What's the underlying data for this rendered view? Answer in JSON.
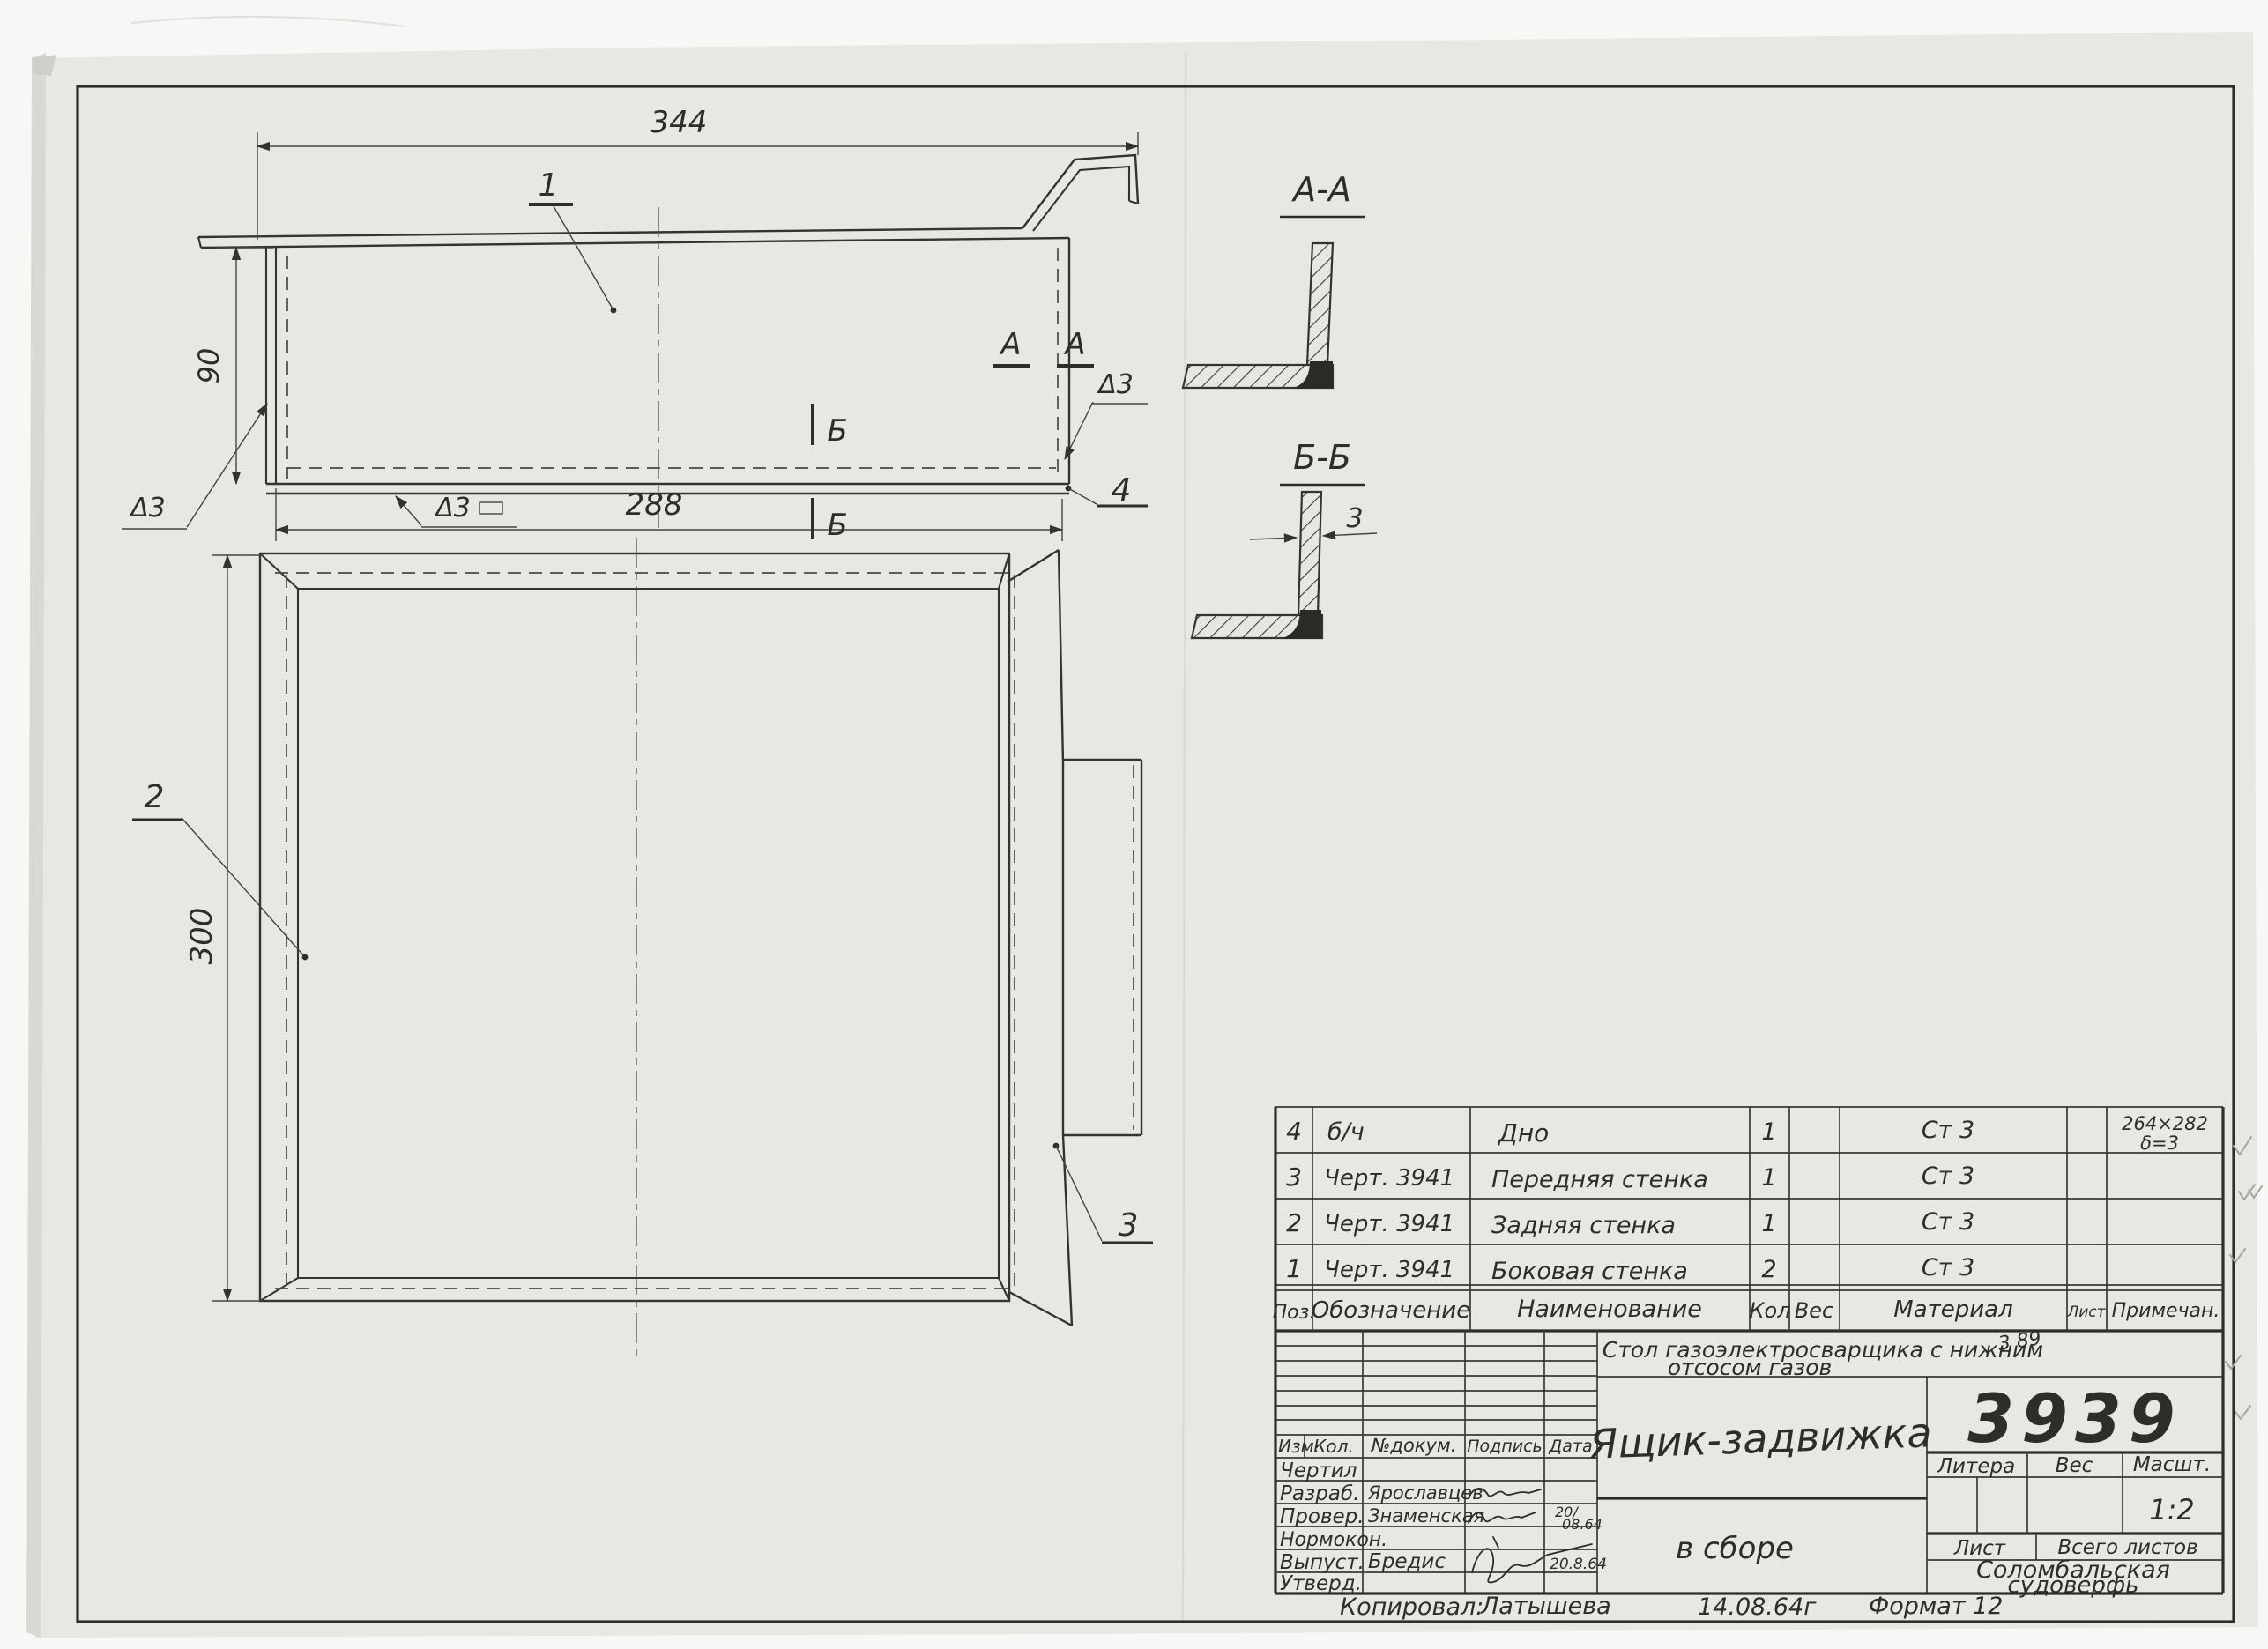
{
  "sheet": {
    "number": "3939",
    "title": "Ящик-задвижка",
    "project_line1": "Стол газоэлектросварщика с нижним",
    "project_line2": "отсосом газов",
    "assembly_note": "в сборе",
    "shipyard_line1": "Соломбальская",
    "shipyard_line2": "судоверфь",
    "scale_value": "1:2",
    "copied_label": "Копировал:",
    "copied_by": "Латышева",
    "copy_date": "14.08.64г",
    "format_note": "Формат 12",
    "pencil_note": "3 89"
  },
  "dims": {
    "overall_width": "344",
    "inner_width": "288",
    "depth": "90",
    "height": "300",
    "thickness": "3"
  },
  "sections": {
    "aa_title": "А-А",
    "bb_title": "Б-Б",
    "mark_a": "А",
    "mark_b": "Б"
  },
  "welds": {
    "left": "Δ3",
    "bottom": "Δ3",
    "right": "Δ3"
  },
  "callouts": {
    "c1": "1",
    "c2": "2",
    "c3": "3",
    "c4": "4"
  },
  "parts_table": {
    "headers": {
      "pos": "Поз.",
      "designation": "Обозначение",
      "name": "Наименование",
      "qty": "Кол",
      "weight": "Вес",
      "material": "Материал",
      "sheet": "Лист",
      "note": "Примечан."
    },
    "rows": [
      {
        "pos": "4",
        "designation": "б/ч",
        "name": "Дно",
        "qty": "1",
        "material": "Ст 3",
        "note1": "264×282",
        "note2": "δ=3"
      },
      {
        "pos": "3",
        "designation": "Черт. 3941",
        "name": "Передняя стенка",
        "qty": "1",
        "material": "Ст 3"
      },
      {
        "pos": "2",
        "designation": "Черт. 3941",
        "name": "Задняя стенка",
        "qty": "1",
        "material": "Ст 3"
      },
      {
        "pos": "1",
        "designation": "Черт. 3941",
        "name": "Боковая стенка",
        "qty": "2",
        "material": "Ст 3"
      }
    ]
  },
  "title_block": {
    "rev_headers": {
      "izm": "Изм.",
      "kol": "Кол.",
      "doc": "№докум.",
      "sign": "Подпись",
      "date": "Дата"
    },
    "roles": {
      "drew": "Чертил",
      "developed": "Разраб.",
      "checked": "Провер.",
      "norm": "Нормокон.",
      "released": "Выпуст.",
      "approved": "Утверд."
    },
    "people": {
      "developed": "Ярославцев",
      "checked": "Знаменская",
      "released": "Бредис"
    },
    "dates": {
      "checked_top": "20/",
      "checked_bottom": "08.64",
      "released": "20.8.64"
    },
    "litera_label": "Литера",
    "weight_label": "Вес",
    "scale_label": "Масшт.",
    "sheet_label": "Лист",
    "total_sheets_label": "Всего листов"
  }
}
